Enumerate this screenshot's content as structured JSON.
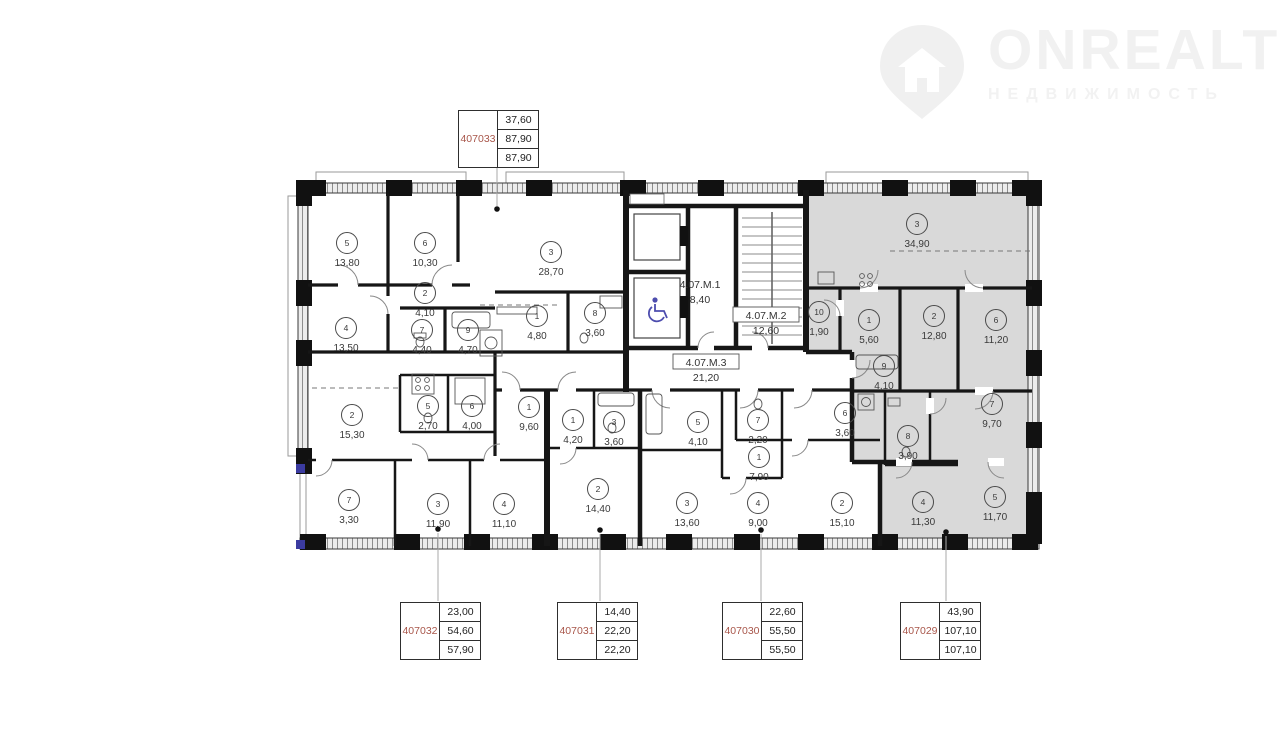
{
  "watermark": {
    "brand": "ONREALT",
    "subtitle": "НЕДВИЖИМОСТЬ"
  },
  "colors": {
    "accent_red": "#a8564a",
    "highlight_apartment_fill": "#d9d9d9",
    "wall": "#161616",
    "wheelchair_blue": "#4d4dae"
  },
  "unit_boxes": [
    {
      "id": "407033",
      "values": [
        "37,60",
        "87,90",
        "87,90"
      ],
      "x": 458,
      "y": 110,
      "line": [
        497,
        168,
        497,
        206
      ],
      "dot": [
        497,
        209
      ]
    },
    {
      "id": "407032",
      "values": [
        "23,00",
        "54,60",
        "57,90"
      ],
      "x": 400,
      "y": 602,
      "line": [
        438,
        533,
        438,
        601
      ],
      "dot": [
        438,
        529
      ]
    },
    {
      "id": "407031",
      "values": [
        "14,40",
        "22,20",
        "22,20"
      ],
      "x": 557,
      "y": 602,
      "line": [
        600,
        534,
        600,
        601
      ],
      "dot": [
        600,
        530
      ]
    },
    {
      "id": "407030",
      "values": [
        "22,60",
        "55,50",
        "55,50"
      ],
      "x": 722,
      "y": 602,
      "line": [
        761,
        534,
        761,
        601
      ],
      "dot": [
        761,
        530
      ]
    },
    {
      "id": "407029",
      "values": [
        "43,90",
        "107,10",
        "107,10"
      ],
      "x": 900,
      "y": 602,
      "line": [
        946,
        536,
        946,
        601
      ],
      "dot": [
        946,
        532
      ]
    }
  ],
  "zones": [
    {
      "label": "4.07.М.1",
      "area": "8,40",
      "x": 700,
      "y": 287,
      "boxed": false
    },
    {
      "label": "4.07.М.2",
      "area": "12,60",
      "x": 766,
      "y": 318,
      "boxed": true
    },
    {
      "label": "4.07.М.3",
      "area": "21,20",
      "x": 706,
      "y": 365,
      "boxed": true
    }
  ],
  "rooms": [
    {
      "apartment": "407033",
      "num": "5",
      "area": "13,80",
      "x": 347,
      "y": 243
    },
    {
      "apartment": "407033",
      "num": "6",
      "area": "10,30",
      "x": 425,
      "y": 243
    },
    {
      "apartment": "407033",
      "num": "3",
      "area": "28,70",
      "x": 551,
      "y": 252
    },
    {
      "apartment": "407033",
      "num": "2",
      "area": "4,10",
      "x": 425,
      "y": 293
    },
    {
      "apartment": "407033",
      "num": "4",
      "area": "13,50",
      "x": 346,
      "y": 328
    },
    {
      "apartment": "407033",
      "num": "7",
      "area": "4,40",
      "x": 422,
      "y": 330
    },
    {
      "apartment": "407033",
      "num": "9",
      "area": "4,70",
      "x": 468,
      "y": 330
    },
    {
      "apartment": "407033",
      "num": "1",
      "area": "4,80",
      "x": 537,
      "y": 316
    },
    {
      "apartment": "407033",
      "num": "8",
      "area": "3,60",
      "x": 595,
      "y": 313
    },
    {
      "apartment": "407029",
      "num": "3",
      "area": "34,90",
      "x": 917,
      "y": 224
    },
    {
      "apartment": "407029",
      "num": "10",
      "area": "1,90",
      "x": 819,
      "y": 312
    },
    {
      "apartment": "407029",
      "num": "1",
      "area": "5,60",
      "x": 869,
      "y": 320
    },
    {
      "apartment": "407029",
      "num": "2",
      "area": "12,80",
      "x": 934,
      "y": 316
    },
    {
      "apartment": "407029",
      "num": "6",
      "area": "11,20",
      "x": 996,
      "y": 320
    },
    {
      "apartment": "407029",
      "num": "9",
      "area": "4,10",
      "x": 884,
      "y": 366
    },
    {
      "apartment": "407029",
      "num": "7",
      "area": "9,70",
      "x": 992,
      "y": 404
    },
    {
      "apartment": "407029",
      "num": "8",
      "area": "3,90",
      "x": 908,
      "y": 436
    },
    {
      "apartment": "407029",
      "num": "4",
      "area": "11,30",
      "x": 923,
      "y": 502
    },
    {
      "apartment": "407029",
      "num": "5",
      "area": "11,70",
      "x": 995,
      "y": 497
    },
    {
      "apartment": "407032",
      "num": "2",
      "area": "15,30",
      "x": 352,
      "y": 415
    },
    {
      "apartment": "407032",
      "num": "5",
      "area": "2,70",
      "x": 428,
      "y": 406
    },
    {
      "apartment": "407032",
      "num": "6",
      "area": "4,00",
      "x": 472,
      "y": 406
    },
    {
      "apartment": "407032",
      "num": "1",
      "area": "9,60",
      "x": 529,
      "y": 407
    },
    {
      "apartment": "407032",
      "num": "7",
      "area": "3,30",
      "x": 349,
      "y": 500
    },
    {
      "apartment": "407032",
      "num": "3",
      "area": "11,90",
      "x": 438,
      "y": 504
    },
    {
      "apartment": "407032",
      "num": "4",
      "area": "11,10",
      "x": 504,
      "y": 504
    },
    {
      "apartment": "407031",
      "num": "1",
      "area": "4,20",
      "x": 573,
      "y": 420
    },
    {
      "apartment": "407031",
      "num": "3",
      "area": "3,60",
      "x": 614,
      "y": 422
    },
    {
      "apartment": "407031",
      "num": "2",
      "area": "14,40",
      "x": 598,
      "y": 489
    },
    {
      "apartment": "407030",
      "num": "5",
      "area": "4,10",
      "x": 698,
      "y": 422
    },
    {
      "apartment": "407030",
      "num": "7",
      "area": "2,20",
      "x": 758,
      "y": 420
    },
    {
      "apartment": "407030",
      "num": "1",
      "area": "7,90",
      "x": 759,
      "y": 457
    },
    {
      "apartment": "407030",
      "num": "3",
      "area": "13,60",
      "x": 687,
      "y": 503
    },
    {
      "apartment": "407030",
      "num": "4",
      "area": "9,00",
      "x": 758,
      "y": 503
    },
    {
      "apartment": "407030",
      "num": "6",
      "area": "3,60",
      "x": 845,
      "y": 413
    },
    {
      "apartment": "407030",
      "num": "2",
      "area": "15,10",
      "x": 842,
      "y": 503
    }
  ]
}
